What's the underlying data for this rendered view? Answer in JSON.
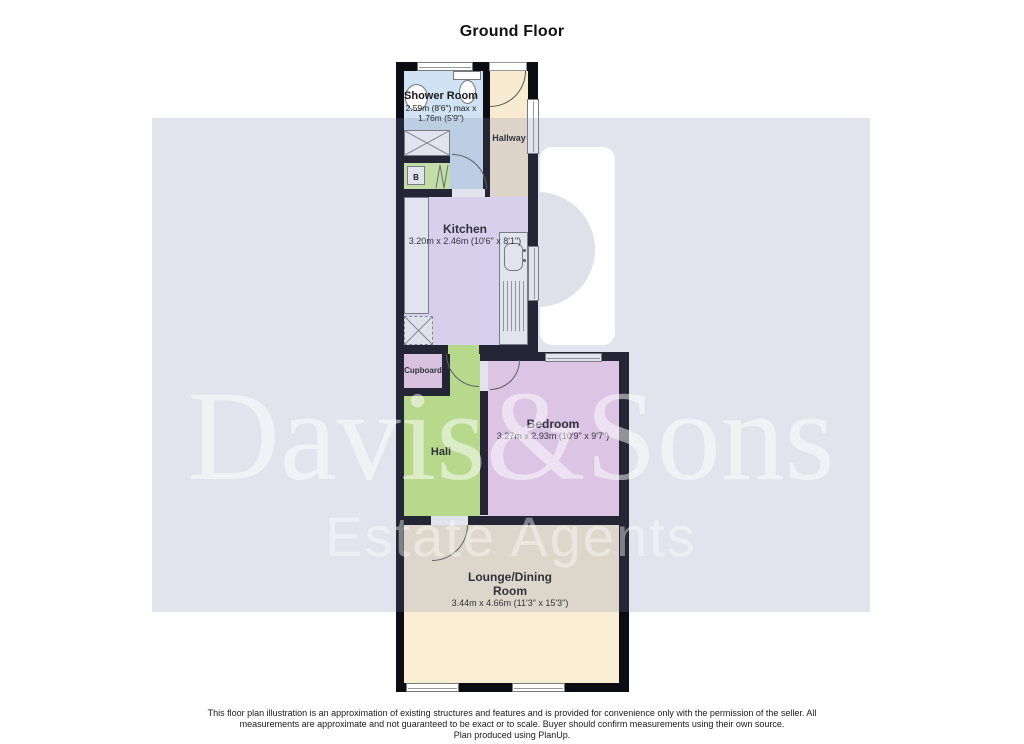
{
  "title": "Ground Floor",
  "rooms": {
    "shower": {
      "name": "Shower Room",
      "dims": "2.59m (8'6\") max x 1.76m (5'9\")"
    },
    "hallway": {
      "name": "Hallway"
    },
    "kitchen": {
      "name": "Kitchen",
      "dims": "3.20m x 2.46m (10'6\" x 8'1\")"
    },
    "cupboard": {
      "name": "Cupboard"
    },
    "hall": {
      "name": "Hall"
    },
    "boiler": {
      "label": "B"
    },
    "bedroom": {
      "name": "Bedroom",
      "dims": "3.27m x 2.93m (10'9\" x 9'7\")"
    },
    "lounge": {
      "name": "Lounge/Dining Room",
      "dims": "3.44m x 4.66m (11'3\" x 15'3\")"
    }
  },
  "watermark": {
    "name": "Davis&Sons",
    "tagline": "Estate Agents"
  },
  "footer": {
    "line1": "This floor plan illustration is an approximation of existing structures and features and is provided for convenience only with the permission of the seller. All",
    "line2": "measurements are approximate and not guaranteed to be exact or to scale.  Buyer should confirm measurements using their own source.",
    "line3": "Plan produced using PlanUp."
  },
  "colors": {
    "wall": "#0c0c14",
    "shower": "#cfe3f4",
    "hallway": "#f9ebd1",
    "kitchen": "#f1e6ff",
    "cupboard": "#f2d4ef",
    "hall": "#c8f183",
    "boilercup": "#d8f7a4",
    "bedroom": "#f6d6f4",
    "lounge": "#f9edd3",
    "band": "rgba(125,132,172,0.22)",
    "wmtext": "rgba(255,255,255,0.50)",
    "wmtext2": "rgba(255,255,255,0.42)"
  }
}
